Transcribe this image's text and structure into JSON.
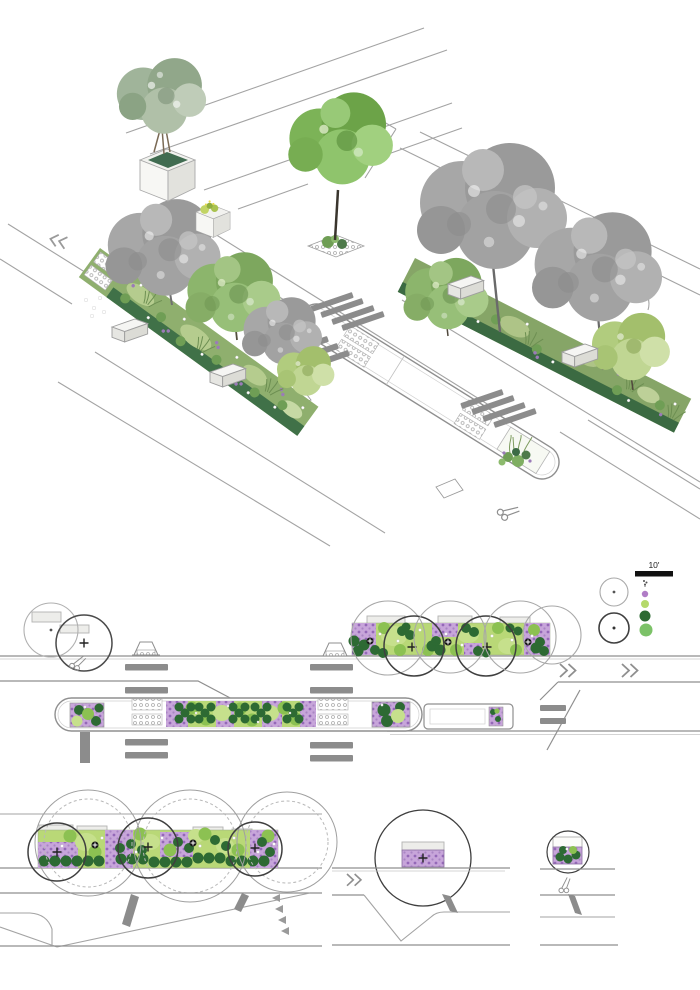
{
  "legend": {
    "scale_label": "10'",
    "tree_symbols": [
      {
        "name": "existing-tree-canopy",
        "stroke": "#a9a9a9"
      },
      {
        "name": "proposed-tree-canopy",
        "stroke": "#3f3f3f"
      }
    ],
    "plant_symbols": [
      {
        "name": "sprig-symbol",
        "color": "#4f4f4f"
      },
      {
        "name": "purple-perennial",
        "color": "#b07cc6"
      },
      {
        "name": "light-green-planting",
        "color": "#b5d96a"
      },
      {
        "name": "dark-green-shrub",
        "color": "#2d6a33"
      },
      {
        "name": "medium-green-shrub",
        "color": "#7cc268"
      }
    ]
  },
  "palette": {
    "purple-base": "#c7a5da",
    "purple-dot": "#9468b8",
    "green-light": "#b9d877",
    "green-mid": "#8cc152",
    "green-dark": "#2d6a33",
    "green-pale": "#c6e08c",
    "line-gray": "#8f8f8f",
    "bar-gray": "#8c8c8c",
    "bench-fill": "#ededea",
    "bench-stroke": "#b2b2b2"
  }
}
